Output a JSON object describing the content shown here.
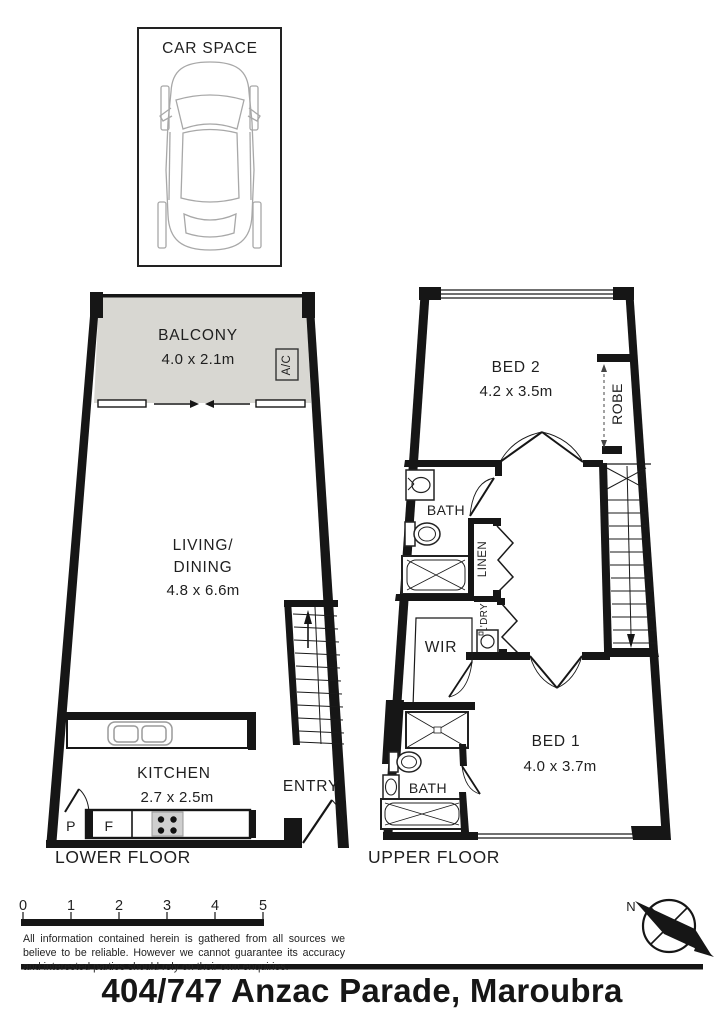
{
  "address": "404/747 Anzac Parade, Maroubra",
  "car_space": {
    "title": "CAR SPACE"
  },
  "lower_floor": {
    "floor_label": "LOWER FLOOR",
    "balcony": {
      "name": "BALCONY",
      "dims": "4.0 x 2.1m"
    },
    "ac_unit": "A/C",
    "living_dining": {
      "name_line1": "LIVING/",
      "name_line2": "DINING",
      "dims": "4.8 x 6.6m"
    },
    "kitchen": {
      "name": "KITCHEN",
      "dims": "2.7 x 2.5m"
    },
    "entry": "ENTRY",
    "pantry": "P",
    "fridge": "F"
  },
  "upper_floor": {
    "floor_label": "UPPER FLOOR",
    "bed2": {
      "name": "BED 2",
      "dims": "4.2 x 3.5m"
    },
    "bed1": {
      "name": "BED 1",
      "dims": "4.0 x 3.7m"
    },
    "robe": "ROBE",
    "bath_main": "BATH",
    "linen": "LINEN",
    "laundry": "L'DRY",
    "wir": "WIR",
    "bath_ensuite": "BATH"
  },
  "scale_bar": {
    "ticks": [
      "0",
      "1",
      "2",
      "3",
      "4",
      "5"
    ]
  },
  "disclaimer": {
    "text": "All information contained herein is gathered from all sources we believe to be reliable. However we cannot guarantee its accuracy and interested parties should rely on their own enquiries."
  },
  "compass": {
    "north": "N"
  },
  "colors": {
    "wall": "#161616",
    "balcony_fill": "#d8d7d2",
    "fixture_gray": "#9a9a9a"
  }
}
